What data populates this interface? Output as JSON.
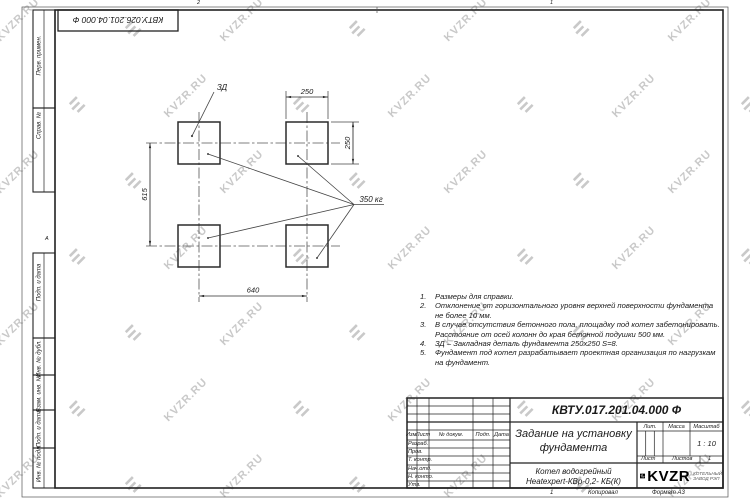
{
  "watermark": {
    "text": "KVZR.RU",
    "color": "#c9c9c9"
  },
  "frame": {
    "top_stamp": "КВТУ.026.201.04.000 Ф",
    "zone_top_left": "2",
    "zone_top_right": "1",
    "zone_left": "А",
    "left_labels": [
      "Перв. примен.",
      "Справ. №",
      "Подп. и дата",
      "Инв. № дубл.",
      "Взам. инв. №",
      "Подп. и дата",
      "Инв. № подл."
    ]
  },
  "drawing": {
    "detail_label": "ЗД",
    "dim_top": "250",
    "dim_right": "250",
    "dim_left": "615",
    "dim_bottom": "640",
    "load_label": "350 кг"
  },
  "notes": [
    {
      "num": "1.",
      "text": "Размеры для справки."
    },
    {
      "num": "2.",
      "text": "Отклонение от горизонтального уровня верхней поверхности фундамента не более 10 мм."
    },
    {
      "num": "3.",
      "text": "В случае отсутствия бетонного пола, площадку под котел забетонировать. Расстояние от осей колонн до края бетонной подушки 500 мм."
    },
    {
      "num": "4.",
      "text": "ЗД – Закладная деталь фундамента 250х250 S=8."
    },
    {
      "num": "5.",
      "text": "Фундамент под котел разрабатывает проектная организация по нагрузкам на фундамент."
    }
  ],
  "title_block": {
    "designation": "КВТУ.017.201.04.000 Ф",
    "title_line1": "Задание на установку",
    "title_line2": "фундамента",
    "product_line1": "Котел водогрейный",
    "product_line2": "Heatexpert-КВр-0,2- КБ(К)",
    "lit_label": "Лит.",
    "mass_label": "Масса",
    "scale_label": "Масштаб",
    "scale_value": "1 : 10",
    "sheet_label": "Лист",
    "sheets_label": "Листов",
    "sheets_value": "1",
    "header_cols": [
      "Изм.",
      "Лист",
      "№ докум.",
      "Подп.",
      "Дата"
    ],
    "rows": [
      "Разраб.",
      "Пров.",
      "Т. контр.",
      "Нач.отд.",
      "Н. контр.",
      "Утв."
    ],
    "logo_text": "KVZR",
    "logo_sub1": "КОТЕЛЬНЫЙ",
    "logo_sub2": "ЗАВОД РЭП",
    "footer_num": "1",
    "footer_copy": "Копировал",
    "footer_format": "Формат А3"
  }
}
